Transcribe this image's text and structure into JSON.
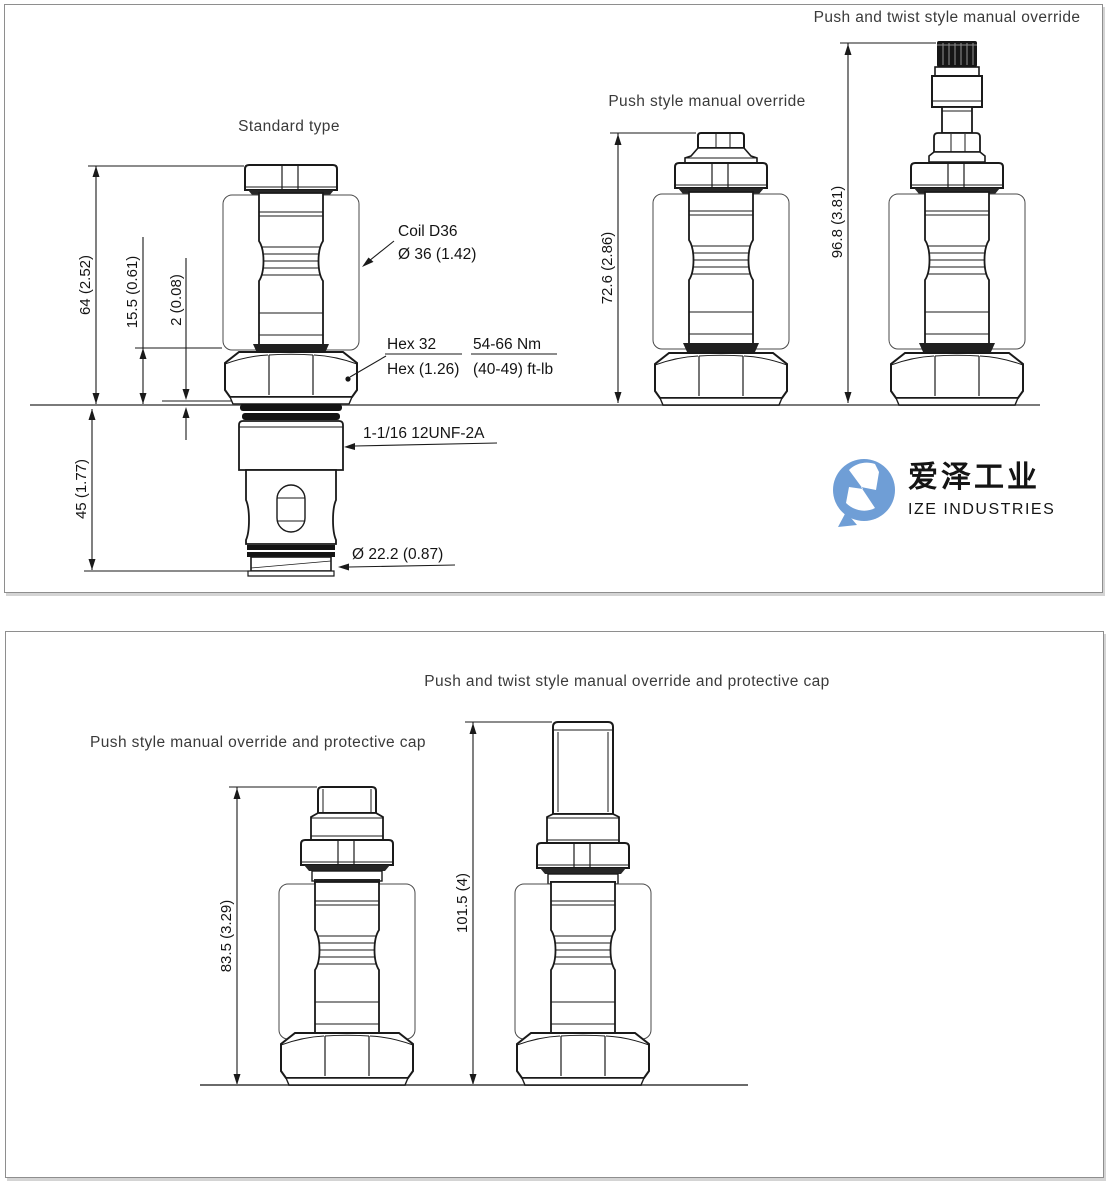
{
  "colors": {
    "line": "#1a1a1a",
    "ground_line": "#7a7a7a",
    "panel_border": "#8e8e8e",
    "title_text": "#3a3a3a",
    "logo_blue": "#6f9ed6",
    "logo_text": "#4d4d4d",
    "logo_subtext": "#9d9d9d"
  },
  "top_panel": {
    "title_standard": "Standard type",
    "title_push": "Push style manual override",
    "title_push_twist": "Push and twist style manual override",
    "dim_overall": "64 (2.52)",
    "dim_nut": "15.5 (0.61)",
    "dim_washer": "2 (0.08)",
    "dim_cartridge": "45 (1.77)",
    "dim_push_overall": "72.6 (2.86)",
    "dim_push_twist_overall": "96.8 (3.81)",
    "callout_coil_1": "Coil D36",
    "callout_coil_2": "Ø 36 (1.42)",
    "callout_hex_1": "Hex 32",
    "callout_hex_2": "Hex (1.26)",
    "callout_torque_1": "54-66 Nm",
    "callout_torque_2": "(40-49) ft-lb",
    "callout_thread": "1-1/16 12UNF-2A",
    "callout_nose": "Ø 22.2 (0.87)"
  },
  "bottom_panel": {
    "title_push_cap": "Push style manual override and protective cap",
    "title_push_twist_cap": "Push and twist style manual override and protective cap",
    "dim_push_cap": "83.5 (3.29)",
    "dim_push_twist_cap": "101.5 (4)"
  },
  "watermark": {
    "cn": "爱泽工业",
    "en": "IZE INDUSTRIES"
  }
}
